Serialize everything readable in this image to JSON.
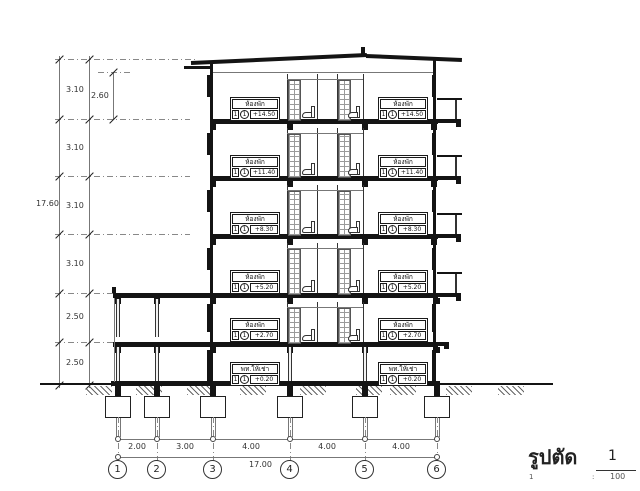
{
  "drawing": {
    "type": "building-section",
    "title": "รูปตัด",
    "number": "1",
    "scale_left": "1",
    "scale_sep": ":",
    "scale_right": "100"
  },
  "vertical_dimensions": {
    "overall": "17.60",
    "segments_top_to_bottom": [
      "3.10",
      "3.10",
      "3.10",
      "3.10",
      "2.50",
      "2.50"
    ],
    "top_floor_clear_height": "2.60"
  },
  "horizontal_dimensions": {
    "spans": [
      "2.00",
      "3.00",
      "4.00",
      "4.00",
      "4.00"
    ],
    "overall": "17.00"
  },
  "grid_bubbles": [
    "1",
    "2",
    "3",
    "4",
    "5",
    "6"
  ],
  "room_tags": [
    {
      "label": "ห้องพัก",
      "box1": "1",
      "box2": "1",
      "level": "+14.50"
    },
    {
      "label": "ห้องพัก",
      "box1": "1",
      "box2": "1",
      "level": "+14.50"
    },
    {
      "label": "ห้องพัก",
      "box1": "1",
      "box2": "1",
      "level": "+11.40"
    },
    {
      "label": "ห้องพัก",
      "box1": "1",
      "box2": "1",
      "level": "+11.40"
    },
    {
      "label": "ห้องพัก",
      "box1": "1",
      "box2": "1",
      "level": "+8.30"
    },
    {
      "label": "ห้องพัก",
      "box1": "1",
      "box2": "1",
      "level": "+8.30"
    },
    {
      "label": "ห้องพัก",
      "box1": "1",
      "box2": "1",
      "level": "+5.20"
    },
    {
      "label": "ห้องพัก",
      "box1": "1",
      "box2": "1",
      "level": "+5.20"
    },
    {
      "label": "ห้องพัก",
      "box1": "1",
      "box2": "1",
      "level": "+2.70"
    },
    {
      "label": "ห้องพัก",
      "box1": "1",
      "box2": "1",
      "level": "+2.70"
    },
    {
      "label": "พท.ให้เช่า",
      "box1": "1",
      "box2": "1",
      "level": "+0.20"
    },
    {
      "label": "พท.ให้เช่า",
      "box1": "1",
      "box2": "1",
      "level": "+0.20"
    }
  ],
  "colors": {
    "line_heavy": "#141414",
    "line_light": "#777777",
    "text": "#333333",
    "paper": "#ffffff"
  }
}
